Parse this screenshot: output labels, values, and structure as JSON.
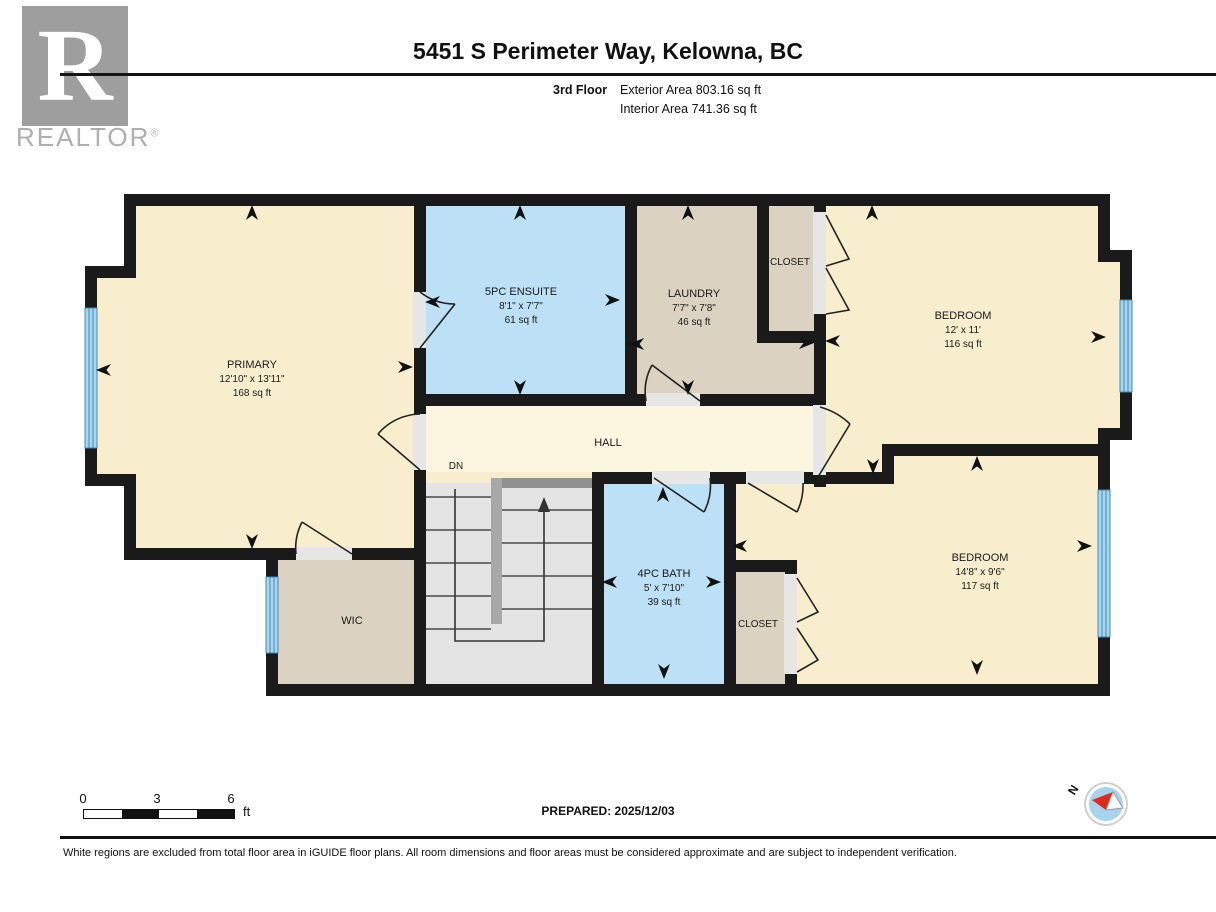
{
  "header": {
    "brand_letter": "R",
    "brand_name": "REALTOR",
    "brand_reg": "®",
    "title": "5451 S Perimeter Way, Kelowna, BC",
    "floor_label": "3rd Floor",
    "exterior_area": "Exterior Area 803.16 sq ft",
    "interior_area": "Interior Area 741.36 sq ft"
  },
  "rooms": {
    "primary": {
      "name": "PRIMARY",
      "dims": "12'10\" x 13'11\"",
      "area": "168 sq ft"
    },
    "ensuite": {
      "name": "5PC ENSUITE",
      "dims": "8'1\" x 7'7\"",
      "area": "61 sq ft"
    },
    "laundry": {
      "name": "LAUNDRY",
      "dims": "7'7\" x 7'8\"",
      "area": "46 sq ft"
    },
    "closet_top": {
      "name": "CLOSET"
    },
    "bedroom_ne": {
      "name": "BEDROOM",
      "dims": "12' x 11'",
      "area": "116 sq ft"
    },
    "hall": {
      "name": "HALL"
    },
    "stairs": {
      "down_label": "DN"
    },
    "bath": {
      "name": "4PC BATH",
      "dims": "5' x 7'10\"",
      "area": "39 sq ft"
    },
    "closet_bottom": {
      "name": "CLOSET"
    },
    "bedroom_se": {
      "name": "BEDROOM",
      "dims": "14'8\" x 9'6\"",
      "area": "117 sq ft"
    },
    "wic": {
      "name": "WIC"
    }
  },
  "scale_bar": {
    "tick_0": "0",
    "tick_1": "3",
    "tick_2": "6",
    "unit": "ft"
  },
  "prepared_label": "PREPARED: 2025/12/03",
  "compass": {
    "north_label": "N"
  },
  "footer": {
    "disclaimer": "White regions are excluded from total floor area in iGUIDE floor plans. All room dimensions and floor areas must be considered approximate and are subject to independent verification."
  },
  "colors": {
    "wall": "#1a1a1a",
    "room_cream": "#F8EECE",
    "hall_cream": "#FCF6E1",
    "room_blue": "#BCE0F6",
    "room_tan": "#DBD2C2",
    "stairs_gray": "#E4E4E4",
    "window_blue": "#A9D6EF",
    "door_gap": "#E6E6E6",
    "compass_red": "#DD2B1C"
  }
}
